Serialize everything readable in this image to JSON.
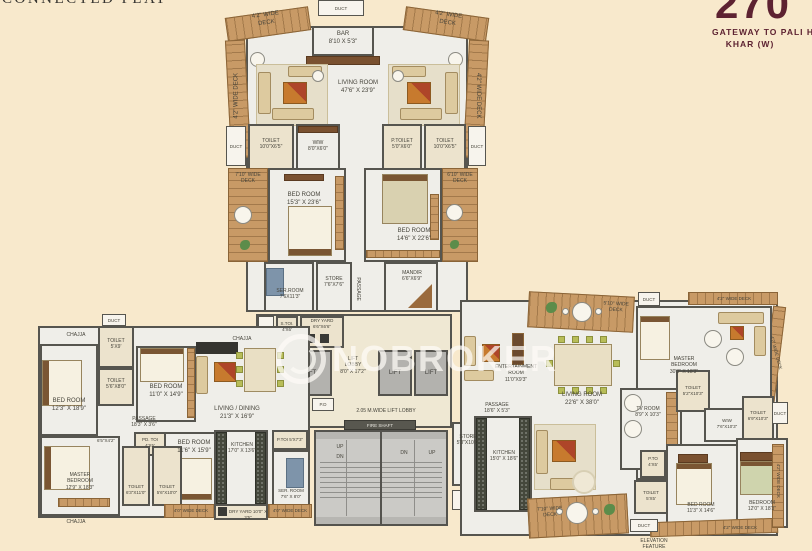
{
  "title": "CONNECTED FLAT",
  "logo": {
    "number": "270",
    "tagline": "GATEWAY TO PALI HILL",
    "location": "KHAR (W)"
  },
  "watermark": "NOBROKER",
  "colors": {
    "maroon": "#5d2231",
    "wood": "#c89a66",
    "background": "#f8e9cc",
    "wall": "#56554f"
  },
  "stairs": {
    "up": "UP",
    "dn": "DN"
  },
  "labels": {
    "duct": {
      "nm": "DUCT"
    },
    "chajja": {
      "nm": "CHAJJA"
    },
    "deck42": {
      "nm": "4'2\" WIDE",
      "dm": "DECK"
    },
    "deck40": {
      "nm": "4'0\" WIDE",
      "dm": "DECK"
    },
    "deck710": {
      "nm": "7'10\" WIDE",
      "dm": "DECK"
    },
    "deck610": {
      "nm": "6'10\" WIDE",
      "dm": "DECK"
    },
    "deck510": {
      "nm": "5'10\" WIDE",
      "dm": "DECK"
    },
    "bar": {
      "nm": "BAR",
      "dm": "8'10 X 5'3\""
    },
    "living_top": {
      "nm": "LIVING ROOM",
      "dm": "47'6\" X 23'9\""
    },
    "toilet_tl": {
      "nm": "TOILET",
      "dm": "10'0\"X6'5\""
    },
    "wiw_top": {
      "nm": "WIW",
      "dm": "8'0\"X6'0\""
    },
    "ptoilet_tr": {
      "nm": "P.TOILET",
      "dm": "5'0\"X6'0\""
    },
    "toilet_tr": {
      "nm": "TOILET",
      "dm": "10'0\"X6'5\""
    },
    "bedroom_tl": {
      "nm": "BED ROOM",
      "dm": "15'3\" X 23'6\""
    },
    "bedroom_tr": {
      "nm": "BED ROOM",
      "dm": "14'6\" X 22'6\""
    },
    "serroom_top": {
      "nm": "SER.ROOM",
      "dm": "7'6X11'3\""
    },
    "store_top": {
      "nm": "STORE",
      "dm": "7'6\"X7'6\""
    },
    "mandir": {
      "nm": "MANDIR",
      "dm": "6'6\"X6'9\""
    },
    "passage": {
      "nm": "PASSAGE"
    },
    "stoi": {
      "nm": "S.TOI.",
      "dm": "4'X6'"
    },
    "dryyard_core": {
      "nm": "DRY YARD",
      "dm": "6'6\"X6'6\""
    },
    "lift": {
      "nm": "LIFT"
    },
    "lift_lobby": {
      "nm": "LIFT",
      "nm2": "LOBBY",
      "dm": "8'0\" X 17'2\""
    },
    "ed": {
      "nm": "E.D"
    },
    "pd": {
      "nm": "P.D"
    },
    "lobby_wide": {
      "nm": "2.05 M.WIDE LIFT LOBBY"
    },
    "fire_shaft": {
      "nm": "FIRE SHAFT"
    },
    "store_core": {
      "nm": "STORE",
      "dm": "5'3\"X10'0\""
    },
    "toilet_lw1": {
      "nm": "TOILET",
      "dm": "5'X9'"
    },
    "toilet_lw2": {
      "nm": "TOILET",
      "dm": "5'6\"X8'0\""
    },
    "bedroom_lw1": {
      "nm": "BED ROOM",
      "dm": "12'3\" X 18'9\""
    },
    "bedroom_lw2": {
      "nm": "BED ROOM",
      "dm": "11'0\" X 14'9\""
    },
    "passage_lw": {
      "nm": "PASSAGE",
      "dm": "18'3\" X 3'6\""
    },
    "foyer_lw": {
      "nm": "6'5\"X4'2\""
    },
    "pdtoi_lw": {
      "nm": "PD. TOI",
      "dm": "4'X5'"
    },
    "bedroom_lw3": {
      "nm": "BED ROOM",
      "dm": "11'6\" X 15'9\""
    },
    "master_lw": {
      "nm": "MASTER",
      "nm2": "BEDROOM",
      "dm": "12'9\" X 18'3\""
    },
    "toilet_lw3": {
      "nm": "TOILET",
      "dm": "6'3\"X11'0\""
    },
    "toilet_lw4": {
      "nm": "TOILET",
      "dm": "5'6\"X10'0\""
    },
    "living_dining": {
      "nm": "LIVING / DINING",
      "dm": "21'3\" X 16'9\""
    },
    "kitchen_lw": {
      "nm": "KITCHEN",
      "dm": "17'0\" X 13'6\""
    },
    "dryyard_lw": {
      "nm": "DRY YARD",
      "dm": "10'0\" X 3'5\""
    },
    "serroom_lw": {
      "nm": "SER. ROOM",
      "dm": "7'6\" X 8'0\""
    },
    "ptoi_lw": {
      "nm": "P.TOI",
      "dm": "5'X7'3\""
    },
    "entertainment": {
      "nm": "ENTERTAINMENT",
      "nm2": "ROOM",
      "dm": "11'0\"X9'3\""
    },
    "living_rw": {
      "nm": "LIVING ROOM",
      "dm": "22'6\" X 38'0\""
    },
    "master_rw": {
      "nm": "MASTER",
      "nm2": "BEDROOM",
      "dm": "30'3\" X 18'3\""
    },
    "passage_rw": {
      "nm": "PASSAGE",
      "dm": "18'6\" X 5'3\""
    },
    "kitchen_rw": {
      "nm": "KITCHEN",
      "dm": "15'0\" X 18'6\""
    },
    "tvroom": {
      "nm": "TV ROOM",
      "dm": "8'9\" X 10'3\""
    },
    "toilet_rw1": {
      "nm": "TOILET",
      "dm": "5'2\"X10'3\""
    },
    "toilet_rw2": {
      "nm": "TOILET",
      "dm": "6'9\"X10'3\""
    },
    "wiw_rw": {
      "nm": "WIW",
      "dm": "7'6\"X10'3\""
    },
    "pto_rw": {
      "nm": "P.TO",
      "dm": "4'X5'"
    },
    "toilet_rw3": {
      "nm": "TOILET",
      "dm": "5'X5'"
    },
    "bedroom_rw1": {
      "nm": "BED ROOM",
      "dm": "11'3\" X 14'6\""
    },
    "bedroom_rw2": {
      "nm": "BEDROOM",
      "dm": "12'0\" X 18'3\""
    },
    "elevation": {
      "nm": "ELEVATION",
      "nm2": "FEATURE"
    }
  }
}
